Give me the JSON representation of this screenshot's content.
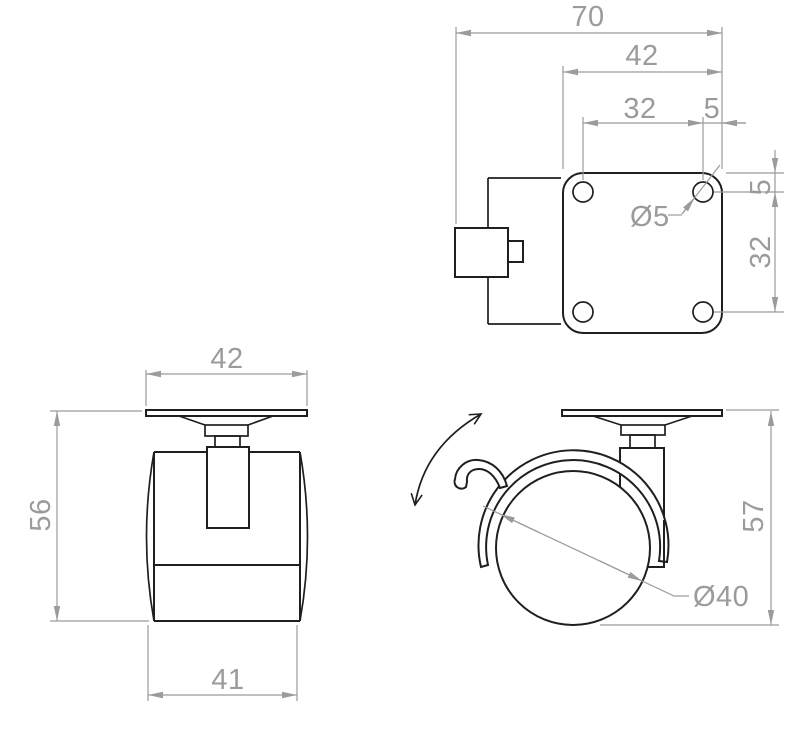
{
  "title": "Swivel caster wheel technical drawing",
  "colors": {
    "outline": "#1f1f1f",
    "dimension": "#9b9b9b",
    "background": "#ffffff"
  },
  "views": {
    "top": {
      "label": "top view - mounting plate",
      "dims": {
        "overall_width": "70",
        "plate_width": "42",
        "hole_pitch_x": "32",
        "hole_offset_x": "5",
        "hole_diameter": "Ø5",
        "hole_offset_y": "5",
        "hole_pitch_y": "32"
      }
    },
    "front": {
      "label": "front view",
      "dims": {
        "plate_width": "42",
        "overall_height": "56",
        "wheel_width": "41"
      }
    },
    "side": {
      "label": "side view",
      "dims": {
        "overall_height": "57",
        "wheel_diameter": "Ø40"
      }
    }
  }
}
